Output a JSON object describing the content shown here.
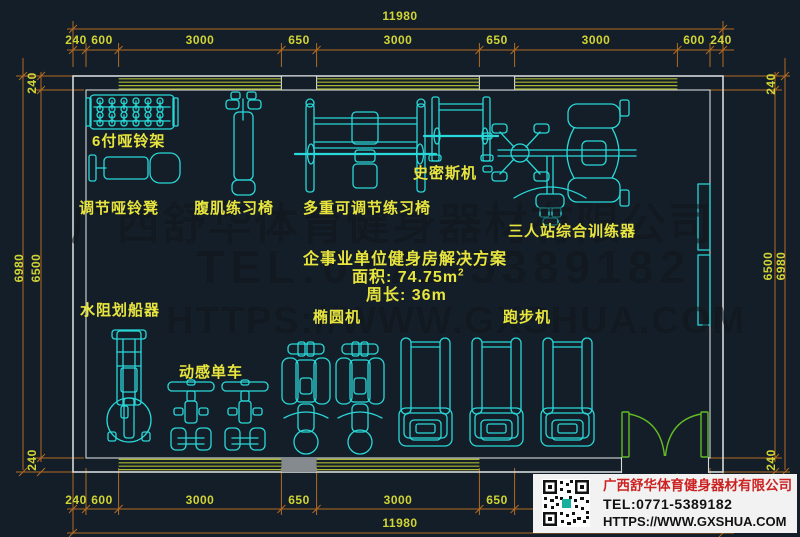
{
  "dims": {
    "total_top": "11980",
    "total_bottom": "11980",
    "top_segments": [
      "240",
      "600",
      "3000",
      "650",
      "3000",
      "650",
      "3000",
      "600",
      "240"
    ],
    "bottom_segments": [
      "240",
      "600",
      "3000",
      "650",
      "3000",
      "650",
      "3000",
      "600",
      "240"
    ],
    "left_outer": "6980",
    "left_inner": "6500",
    "left_top": "240",
    "left_bottom": "240",
    "right_outer": "6980",
    "right_inner": "6500",
    "right_top": "240",
    "right_bottom": "240"
  },
  "labels": {
    "dumbbell_rack": "6付哑铃架",
    "adjustable_bench": "调节哑铃凳",
    "ab_chair": "腹肌练习椅",
    "multi_bench": "多重可调节练习椅",
    "smith_machine": "史密斯机",
    "station3": "三人站综合训练器",
    "rower": "水阻划船器",
    "spin_bike": "动感单车",
    "elliptical": "椭圆机",
    "treadmill": "跑步机"
  },
  "solution": {
    "title": "企事业单位健身房解决方案",
    "area_prefix": "面积: 74.75m",
    "area_sup": "2",
    "perimeter": "周长: 36m"
  },
  "watermark": {
    "company": "广西舒华体育健身器材有限公司",
    "tel": "TEL:0771-5389182",
    "url": "HTTPS://WWW.GXSHUA.COM"
  },
  "info_box": {
    "company": "广西舒华体育健身器材有限公司",
    "tel": "TEL:0771-5389182",
    "url": "HTTPS://WWW.GXSHUA.COM"
  },
  "colors": {
    "bg": "#141e28",
    "equipment": "#29d8d8",
    "window": "#a9b633",
    "door": "#63bc25",
    "dim_line": "#b26b22",
    "dim_text": "#d0d435",
    "label_text": "#e8e53e",
    "wall": "#d5d9da",
    "info_red": "#cc2222"
  }
}
